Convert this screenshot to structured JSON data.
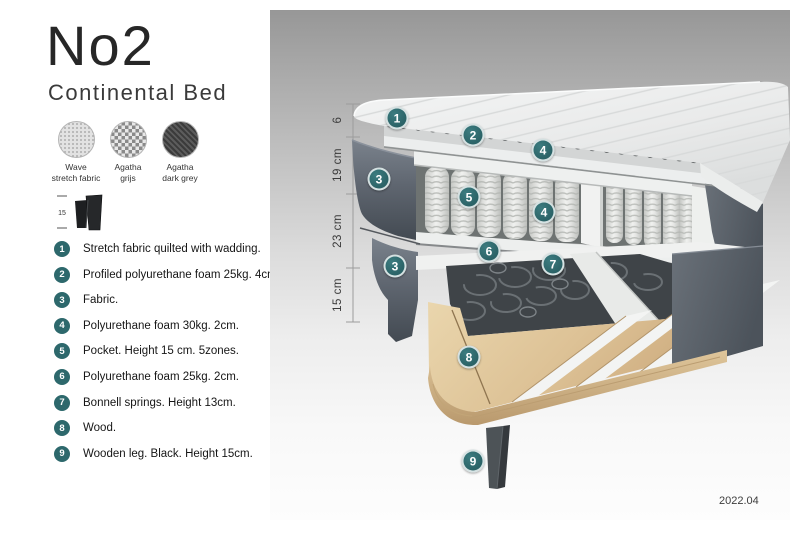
{
  "product": {
    "title": "No2",
    "subtitle": "Continental Bed"
  },
  "swatches": [
    {
      "name": "Wave stretch fabric",
      "line1": "Wave",
      "line2": "stretch fabric",
      "pattern": "speckle-light"
    },
    {
      "name": "Agatha grijs",
      "line1": "Agatha",
      "line2": "grijs",
      "pattern": "check-grey"
    },
    {
      "name": "Agatha dark grey",
      "line1": "Agatha",
      "line2": "dark grey",
      "pattern": "weave-dark"
    }
  ],
  "leg_icon": {
    "height_label": "15"
  },
  "legend": {
    "items": [
      {
        "num": "1",
        "text": "Stretch fabric quilted with wadding."
      },
      {
        "num": "2",
        "text": "Profiled polyurethane foam 25kg. 4cm."
      },
      {
        "num": "3",
        "text": "Fabric."
      },
      {
        "num": "4",
        "text": "Polyurethane foam 30kg. 2cm."
      },
      {
        "num": "5",
        "text": "Pocket. Height 15 cm. 5zones."
      },
      {
        "num": "6",
        "text": "Polyurethane foam 25kg. 2cm."
      },
      {
        "num": "7",
        "text": "Bonnell springs. Height 13cm."
      },
      {
        "num": "8",
        "text": "Wood."
      },
      {
        "num": "9",
        "text": "Wooden leg. Black. Height 15cm."
      }
    ]
  },
  "diagram": {
    "dimensions": [
      {
        "label": "6"
      },
      {
        "label": "19 cm"
      },
      {
        "label": "23 cm"
      },
      {
        "label": "15 cm"
      }
    ],
    "callouts": [
      {
        "num": "1"
      },
      {
        "num": "2"
      },
      {
        "num": "4"
      },
      {
        "num": "3"
      },
      {
        "num": "5"
      },
      {
        "num": "4"
      },
      {
        "num": "6"
      },
      {
        "num": "3"
      },
      {
        "num": "7"
      },
      {
        "num": "8"
      },
      {
        "num": "9"
      }
    ],
    "colors": {
      "callout_teal": "#2d686c",
      "fabric_grey": "#636a73",
      "wood": "#dcc094"
    }
  },
  "footer": {
    "version": "2022.04"
  }
}
